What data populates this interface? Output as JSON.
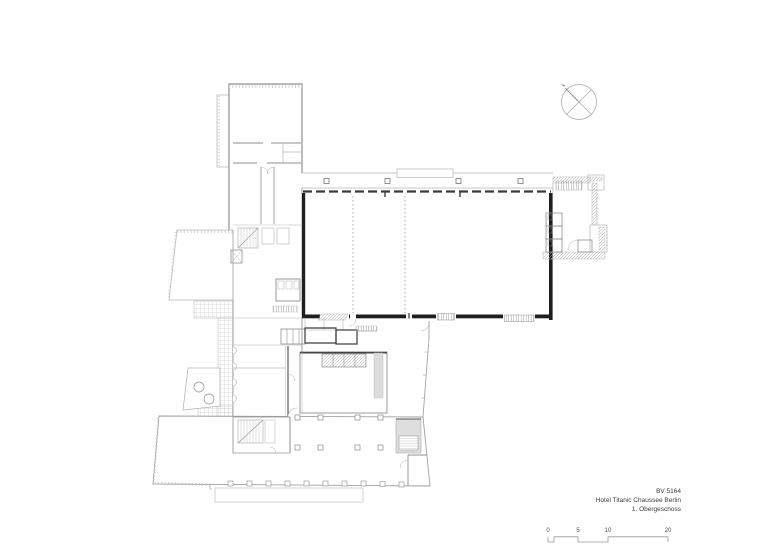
{
  "titleblock": {
    "project_id": "BV 5164",
    "project_name": "Hotel Titanic Chaussee Berlin",
    "sheet_name": "1. Obergeschoss"
  },
  "scale_bar": {
    "labels": [
      "0",
      "5",
      "10",
      "20"
    ]
  },
  "icons": {
    "north_arrow": "north-arrow-icon"
  },
  "colors": {
    "background": "#ffffff",
    "line_light": "#b5b5b5",
    "line_medium": "#8c8c8c",
    "wall_dark": "#1f1f1f",
    "text": "#3d3d3d"
  }
}
